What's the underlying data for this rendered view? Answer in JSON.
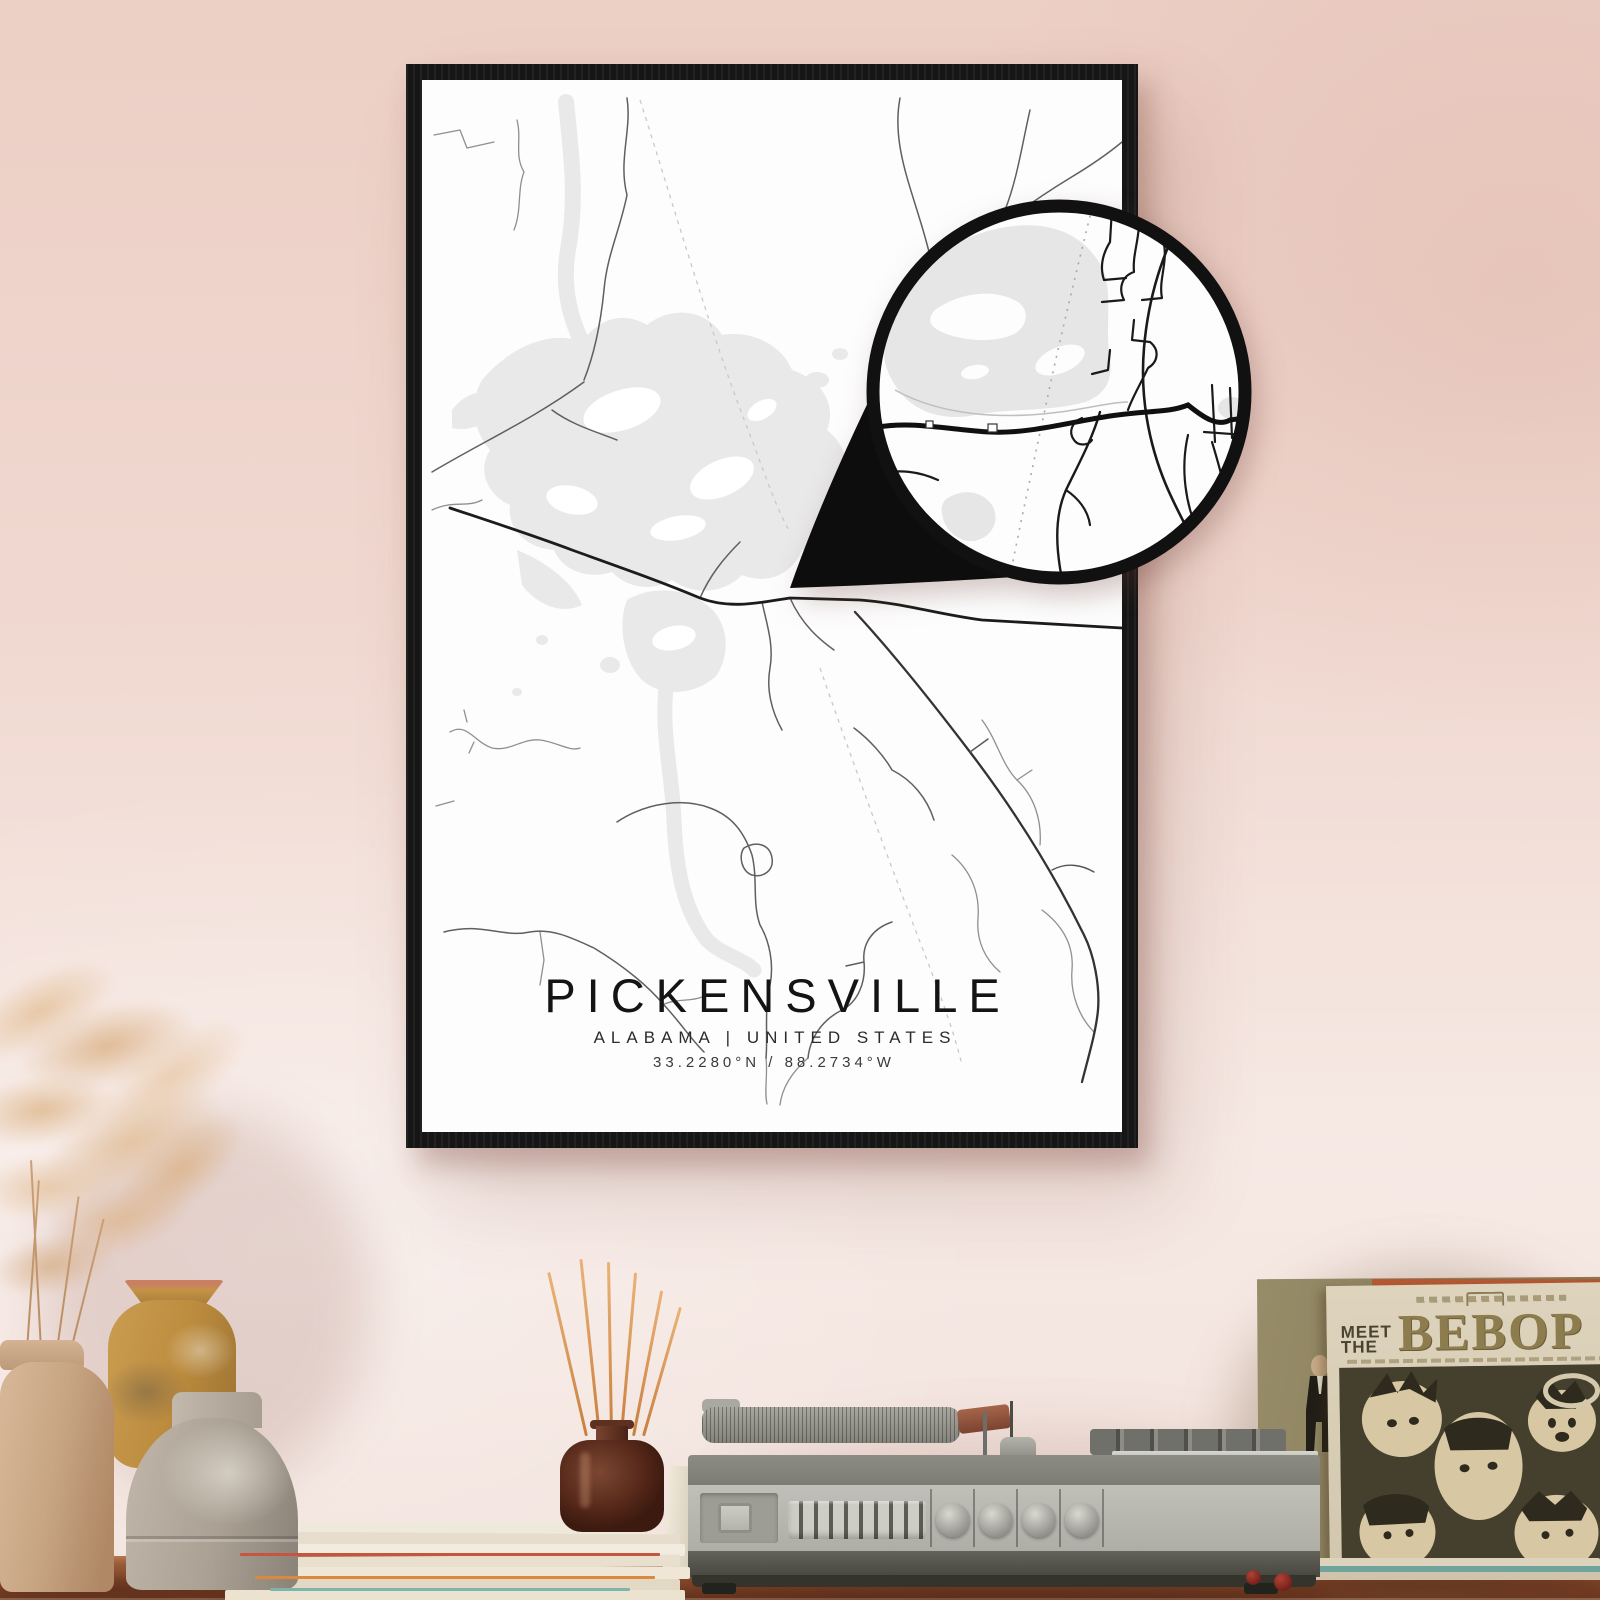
{
  "poster": {
    "title": "PICKENSVILLE",
    "subtitle": "ALABAMA | UNITED STATES",
    "coordinates": "33.2280°N / 88.2734°W"
  },
  "sleeve": {
    "line1": "MEET",
    "line2": "THE",
    "title": "BEBOP"
  },
  "colors": {
    "wall_top": "#eccfc5",
    "wall_bottom": "#f6e9e4",
    "frame": "#161616",
    "poster_bg": "#fdfdfd",
    "map_water": "#e9e9e9",
    "road_major": "#1c1c1c",
    "road_minor": "#8a8a8a",
    "magnifier_ring": "#111111",
    "table_wood": "#82472a",
    "player_body": "#b9b9b1",
    "sleeve_cream": "#d8cdb2",
    "sleeve_khaki": "#8d7c4e",
    "diffuser_glass": "#57291a",
    "reed_orange": "#c97f3e"
  }
}
